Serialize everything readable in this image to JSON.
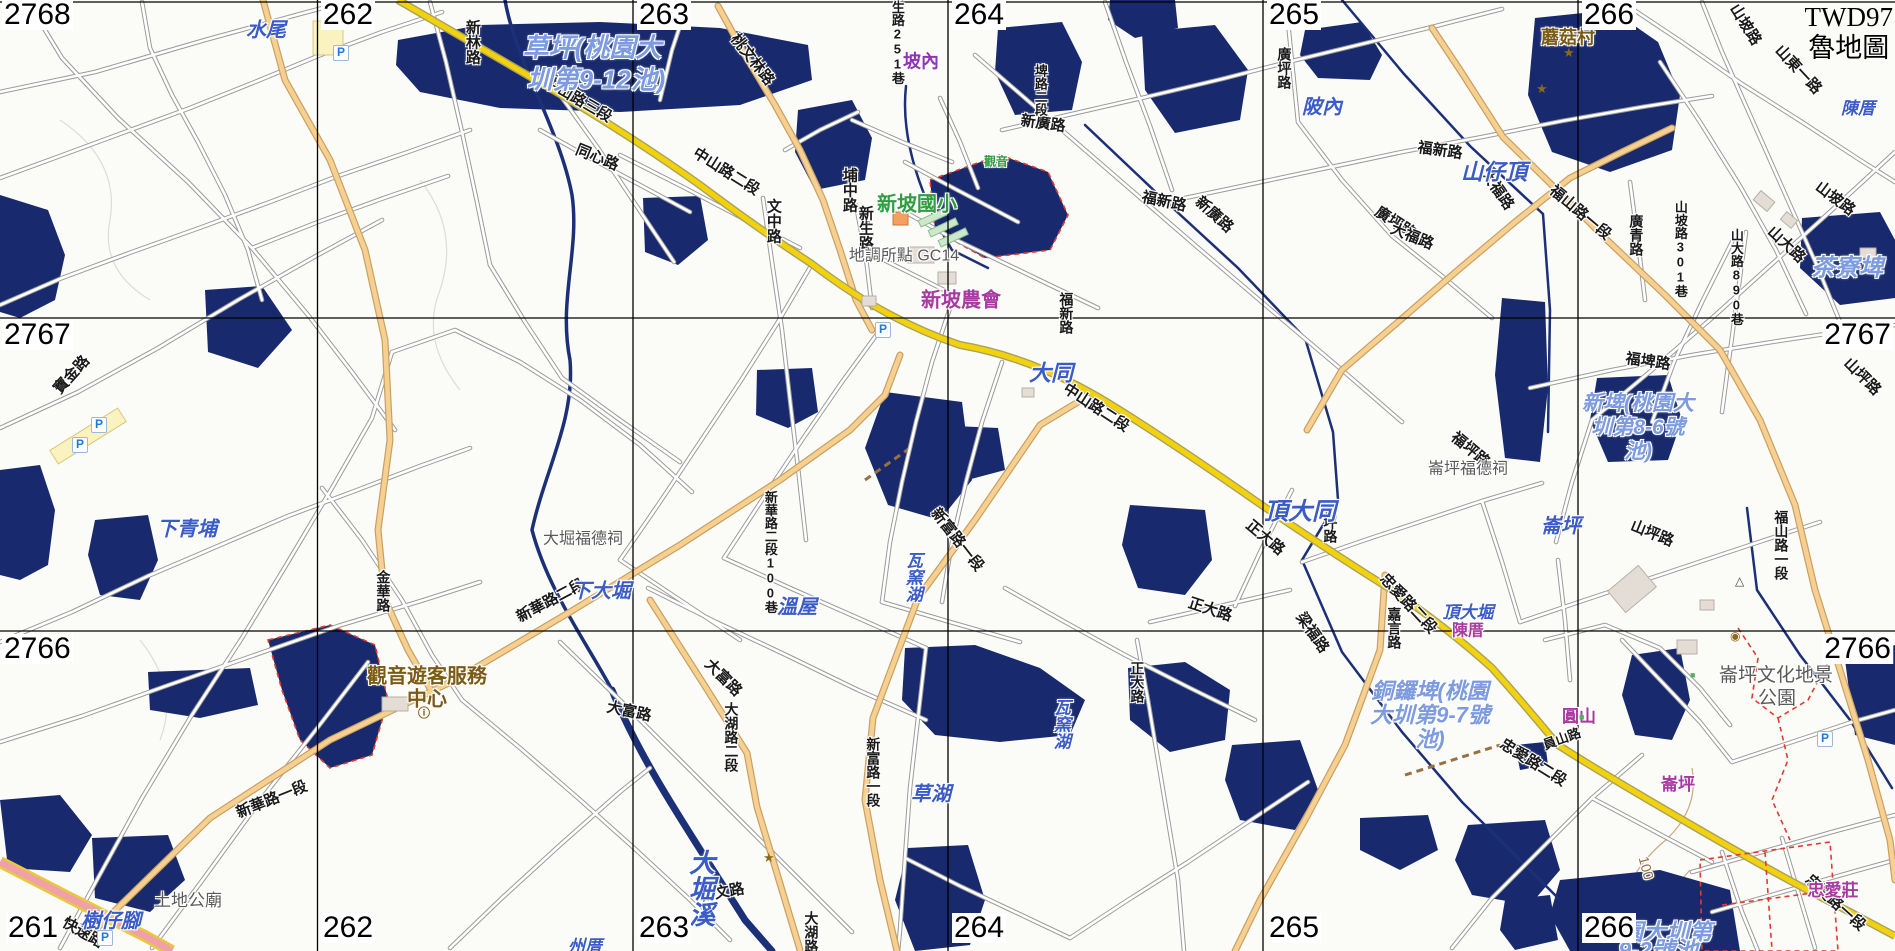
{
  "title": {
    "crs": "TWD97",
    "style": "魯地圖"
  },
  "grid": {
    "top": [
      {
        "t": "262",
        "x": 321
      },
      {
        "t": "263",
        "x": 637
      },
      {
        "t": "264",
        "x": 952
      },
      {
        "t": "265",
        "x": 1267
      },
      {
        "t": "266",
        "x": 1582
      }
    ],
    "bottom": [
      {
        "t": "261",
        "x": 6
      },
      {
        "t": "262",
        "x": 321
      },
      {
        "t": "263",
        "x": 637
      },
      {
        "t": "264",
        "x": 952
      },
      {
        "t": "265",
        "x": 1267
      },
      {
        "t": "266",
        "x": 1582
      }
    ],
    "left": [
      {
        "t": "2768",
        "y": 0
      },
      {
        "t": "2767",
        "y": 320
      },
      {
        "t": "2766",
        "y": 634
      }
    ],
    "right": [
      {
        "t": "2767",
        "y": 320
      },
      {
        "t": "2766",
        "y": 634
      }
    ]
  },
  "labels": [
    {
      "t": "新林路",
      "x": 472,
      "y": 42,
      "c": "road",
      "v": 1
    },
    {
      "t": "桃文林路",
      "x": 752,
      "y": 60,
      "c": "road",
      "r": 52
    },
    {
      "t": "中山路三段",
      "x": 578,
      "y": 100,
      "c": "road",
      "r": 30
    },
    {
      "t": "同心路",
      "x": 597,
      "y": 158,
      "c": "road",
      "r": 22
    },
    {
      "t": "中山路二段",
      "x": 726,
      "y": 172,
      "c": "road",
      "r": 32
    },
    {
      "t": "埔中路",
      "x": 849,
      "y": 190,
      "c": "road",
      "v": 1
    },
    {
      "t": "文中路",
      "x": 773,
      "y": 221,
      "c": "road",
      "v": 1
    },
    {
      "t": "新生路",
      "x": 865,
      "y": 228,
      "c": "road",
      "v": 1
    },
    {
      "t": "新生路251巷",
      "x": 897,
      "y": 36,
      "c": "road",
      "v": 1,
      "fs": 13
    },
    {
      "t": "新廣路",
      "x": 1043,
      "y": 124,
      "c": "road",
      "r": 8
    },
    {
      "t": "埤路二段",
      "x": 1040,
      "y": 90,
      "c": "road",
      "v": 1,
      "fs": 13
    },
    {
      "t": "廣坪路",
      "x": 1284,
      "y": 68,
      "c": "road",
      "v": 1,
      "fs": 14
    },
    {
      "t": "福新路",
      "x": 1164,
      "y": 202,
      "c": "road",
      "r": 12
    },
    {
      "t": "新廣路",
      "x": 1214,
      "y": 215,
      "c": "road",
      "r": 42
    },
    {
      "t": "福新路",
      "x": 1440,
      "y": 151,
      "c": "road",
      "r": 8
    },
    {
      "t": "廣坪路",
      "x": 1395,
      "y": 223,
      "c": "road",
      "r": 33
    },
    {
      "t": "大福路",
      "x": 1412,
      "y": 237,
      "c": "road",
      "r": 22
    },
    {
      "t": "大福路",
      "x": 1497,
      "y": 190,
      "c": "road",
      "r": 55
    },
    {
      "t": "山坡路",
      "x": 1745,
      "y": 25,
      "c": "road",
      "r": 58
    },
    {
      "t": "山東一路",
      "x": 1798,
      "y": 70,
      "c": "road",
      "r": 47
    },
    {
      "t": "山坡路",
      "x": 1835,
      "y": 199,
      "c": "road",
      "r": 37
    },
    {
      "t": "山大路",
      "x": 1786,
      "y": 245,
      "c": "road",
      "r": 43
    },
    {
      "t": "山大路890巷",
      "x": 1736,
      "y": 277,
      "c": "road",
      "v": 1,
      "fs": 13
    },
    {
      "t": "山坡路301巷",
      "x": 1680,
      "y": 249,
      "c": "road",
      "v": 1,
      "fs": 13
    },
    {
      "t": "廣青路",
      "x": 1636,
      "y": 235,
      "c": "road",
      "v": 1,
      "fs": 14
    },
    {
      "t": "福山路一段",
      "x": 1580,
      "y": 213,
      "c": "road",
      "r": 40
    },
    {
      "t": "福埤路",
      "x": 1648,
      "y": 362,
      "c": "road",
      "r": 8
    },
    {
      "t": "中山路二段",
      "x": 1096,
      "y": 408,
      "c": "road",
      "r": 33
    },
    {
      "t": "福新路",
      "x": 1066,
      "y": 313,
      "c": "road",
      "v": 1,
      "fs": 14
    },
    {
      "t": "山坪路",
      "x": 1652,
      "y": 534,
      "c": "road",
      "r": 22
    },
    {
      "t": "山坪路",
      "x": 1862,
      "y": 377,
      "c": "road",
      "r": 45
    },
    {
      "t": "福坪路",
      "x": 1330,
      "y": 522,
      "c": "road",
      "v": 1,
      "fs": 14
    },
    {
      "t": "福坪路",
      "x": 1470,
      "y": 450,
      "c": "road",
      "r": 40
    },
    {
      "t": "正大路",
      "x": 1265,
      "y": 538,
      "c": "road",
      "r": 40
    },
    {
      "t": "正大路",
      "x": 1210,
      "y": 610,
      "c": "road",
      "r": 18
    },
    {
      "t": "正大路",
      "x": 1137,
      "y": 682,
      "c": "road",
      "v": 1,
      "fs": 14
    },
    {
      "t": "梁福路",
      "x": 1312,
      "y": 633,
      "c": "road",
      "r": 55
    },
    {
      "t": "嘉言路",
      "x": 1394,
      "y": 628,
      "c": "road",
      "v": 1,
      "fs": 14
    },
    {
      "t": "忠愛路二段",
      "x": 1408,
      "y": 604,
      "c": "road",
      "r": 47
    },
    {
      "t": "忠愛路二段",
      "x": 1533,
      "y": 763,
      "c": "road",
      "r": 32
    },
    {
      "t": "忠愛路一段",
      "x": 1835,
      "y": 903,
      "c": "road",
      "r": 42
    },
    {
      "t": "員山路",
      "x": 1562,
      "y": 739,
      "c": "road",
      "r": -20,
      "fs": 13
    },
    {
      "t": "福山路一段",
      "x": 1781,
      "y": 545,
      "c": "road",
      "v": 1,
      "fs": 14
    },
    {
      "t": "新華路一段",
      "x": 272,
      "y": 800,
      "c": "road",
      "r": -22
    },
    {
      "t": "新華路二段",
      "x": 551,
      "y": 601,
      "c": "road",
      "r": -28
    },
    {
      "t": "新華路二段100巷",
      "x": 770,
      "y": 552,
      "c": "road",
      "v": 1,
      "fs": 13
    },
    {
      "t": "金華路",
      "x": 383,
      "y": 591,
      "c": "road",
      "v": 1,
      "fs": 14
    },
    {
      "t": "大富路",
      "x": 629,
      "y": 712,
      "c": "road",
      "r": 12
    },
    {
      "t": "大富路",
      "x": 723,
      "y": 678,
      "c": "road",
      "r": 45
    },
    {
      "t": "大湖路二段",
      "x": 731,
      "y": 737,
      "c": "road",
      "v": 1,
      "fs": 14
    },
    {
      "t": "新富路一段",
      "x": 957,
      "y": 540,
      "c": "road",
      "r": 52
    },
    {
      "t": "新富路一段",
      "x": 873,
      "y": 772,
      "c": "road",
      "v": 1,
      "fs": 14
    },
    {
      "t": "新文路",
      "x": 722,
      "y": 893,
      "c": "road",
      "r": -10
    },
    {
      "t": "大湖路",
      "x": 811,
      "y": 932,
      "c": "road",
      "v": 1,
      "fs": 14
    },
    {
      "t": "快速路",
      "x": 83,
      "y": 933,
      "c": "road",
      "r": 30
    },
    {
      "t": "寶金路",
      "x": 72,
      "y": 375,
      "c": "road",
      "r": -48
    },
    {
      "t": "水尾",
      "x": 266,
      "y": 31,
      "c": "place"
    },
    {
      "t": "陂內",
      "x": 1322,
      "y": 108,
      "c": "place"
    },
    {
      "t": "山仔頂",
      "x": 1494,
      "y": 172,
      "c": "place",
      "fs": 22
    },
    {
      "t": "下青埔",
      "x": 187,
      "y": 530,
      "c": "place"
    },
    {
      "t": "下大堀",
      "x": 601,
      "y": 592,
      "c": "place"
    },
    {
      "t": "溫屋",
      "x": 797,
      "y": 608,
      "c": "place"
    },
    {
      "t": "草湖",
      "x": 931,
      "y": 795,
      "c": "place"
    },
    {
      "t": "大同",
      "x": 1051,
      "y": 373,
      "c": "place",
      "fs": 22
    },
    {
      "t": "頂大同",
      "x": 1300,
      "y": 512,
      "c": "place",
      "fs": 24
    },
    {
      "t": "頂大堀",
      "x": 1468,
      "y": 613,
      "c": "place",
      "fs": 17
    },
    {
      "t": "崙坪",
      "x": 1561,
      "y": 527,
      "c": "place"
    },
    {
      "t": "陳厝",
      "x": 1858,
      "y": 109,
      "c": "place",
      "fs": 17
    },
    {
      "t": "樹仔腳",
      "x": 111,
      "y": 922,
      "c": "place"
    },
    {
      "t": "瓦窯湖",
      "x": 912,
      "y": 577,
      "c": "place",
      "v": 1,
      "fs": 17
    },
    {
      "t": "瓦窯湖",
      "x": 1060,
      "y": 724,
      "c": "place",
      "v": 1,
      "fs": 17
    },
    {
      "t": "大堀溪",
      "x": 700,
      "y": 888,
      "c": "place",
      "v": 1,
      "fs": 26
    },
    {
      "t": "州厝",
      "x": 585,
      "y": 947,
      "c": "place",
      "fs": 17
    },
    {
      "t": "草坪(桃園大",
      "x": 592,
      "y": 48,
      "c": "pond",
      "fs": 26
    },
    {
      "t": "圳第9-12池)",
      "x": 596,
      "y": 80,
      "c": "pond",
      "fs": 26
    },
    {
      "t": "茶寮埤",
      "x": 1847,
      "y": 268,
      "c": "pond",
      "fs": 24
    },
    {
      "t": "新埤(桃園大",
      "x": 1638,
      "y": 404,
      "c": "pond",
      "fs": 21
    },
    {
      "t": "圳第8-6號",
      "x": 1638,
      "y": 428,
      "c": "pond",
      "fs": 21
    },
    {
      "t": "池)",
      "x": 1638,
      "y": 452,
      "c": "pond",
      "fs": 21
    },
    {
      "t": "銅鑼埤(桃園",
      "x": 1430,
      "y": 691,
      "c": "pond"
    },
    {
      "t": "大圳第9-7號",
      "x": 1430,
      "y": 715,
      "c": "pond"
    },
    {
      "t": "池)",
      "x": 1430,
      "y": 739,
      "c": "pond"
    },
    {
      "t": "園大圳第",
      "x": 1666,
      "y": 932,
      "c": "pond",
      "fs": 23
    },
    {
      "t": "9-2號池",
      "x": 1658,
      "y": 950,
      "c": "pond",
      "fs": 23
    },
    {
      "t": "坡內",
      "x": 921,
      "y": 62,
      "c": "pur"
    },
    {
      "t": "新坡農會",
      "x": 961,
      "y": 301,
      "c": "ham",
      "fs": 20
    },
    {
      "t": "陳厝",
      "x": 1468,
      "y": 632,
      "c": "ham",
      "fs": 16
    },
    {
      "t": "崙坪",
      "x": 1678,
      "y": 785,
      "c": "ham",
      "fs": 17
    },
    {
      "t": "忠愛莊",
      "x": 1833,
      "y": 891,
      "c": "ham",
      "fs": 17
    },
    {
      "t": "圓山",
      "x": 1579,
      "y": 717,
      "c": "ham",
      "fs": 17
    },
    {
      "t": "蘑菇村",
      "x": 1568,
      "y": 38,
      "c": "poi",
      "fs": 18
    },
    {
      "t": "觀音遊客服務",
      "x": 427,
      "y": 677,
      "c": "poi"
    },
    {
      "t": "中心",
      "x": 427,
      "y": 700,
      "c": "poi"
    },
    {
      "t": "大堀福德祠",
      "x": 583,
      "y": 540,
      "c": "gray",
      "fs": 16
    },
    {
      "t": "崙坪福德祠",
      "x": 1468,
      "y": 470,
      "c": "gray",
      "fs": 16
    },
    {
      "t": "土地公廟",
      "x": 188,
      "y": 901,
      "c": "gray"
    },
    {
      "t": "地調所點 GC14",
      "x": 904,
      "y": 257,
      "c": "gray",
      "fs": 16
    },
    {
      "t": "崙坪文化地景",
      "x": 1776,
      "y": 676,
      "c": "gray",
      "fs": 19
    },
    {
      "t": "公園",
      "x": 1777,
      "y": 699,
      "c": "gray",
      "fs": 19
    },
    {
      "t": "新坡國小",
      "x": 917,
      "y": 205,
      "c": "green"
    },
    {
      "t": "觀音",
      "x": 996,
      "y": 162,
      "c": "green",
      "fs": 12
    },
    {
      "t": "100",
      "x": 1646,
      "y": 868,
      "c": "contour",
      "r": 75
    }
  ],
  "icons": {
    "parking": [
      [
        340,
        52
      ],
      [
        79,
        444
      ],
      [
        98,
        424
      ],
      [
        882,
        329
      ],
      [
        1824,
        738
      ],
      [
        104,
        937
      ]
    ],
    "stars": [
      [
        1570,
        53
      ],
      [
        1543,
        89
      ],
      [
        770,
        858
      ]
    ],
    "info": [
      [
        425,
        714
      ]
    ],
    "triangle": [
      [
        1742,
        582
      ]
    ],
    "well": [
      [
        1737,
        637
      ]
    ],
    "survey": [
      [
        872,
        222
      ]
    ],
    "green_dots": [
      [
        1697,
        678
      ],
      [
        1586,
        720
      ]
    ]
  },
  "colors": {
    "pond": "#182a6d",
    "river": "#1c3078",
    "yellow_road": "#f2d10e",
    "orange_road": "#f6cf92",
    "expressway": "#f0a0a8",
    "grid": "#000000",
    "place_blue": "#3b5bc8",
    "pond_blue": "#7d9be0",
    "hamlet_magenta": "#a839a0",
    "poi_brown": "#7a5b16",
    "school_green": "#2f9e40"
  }
}
